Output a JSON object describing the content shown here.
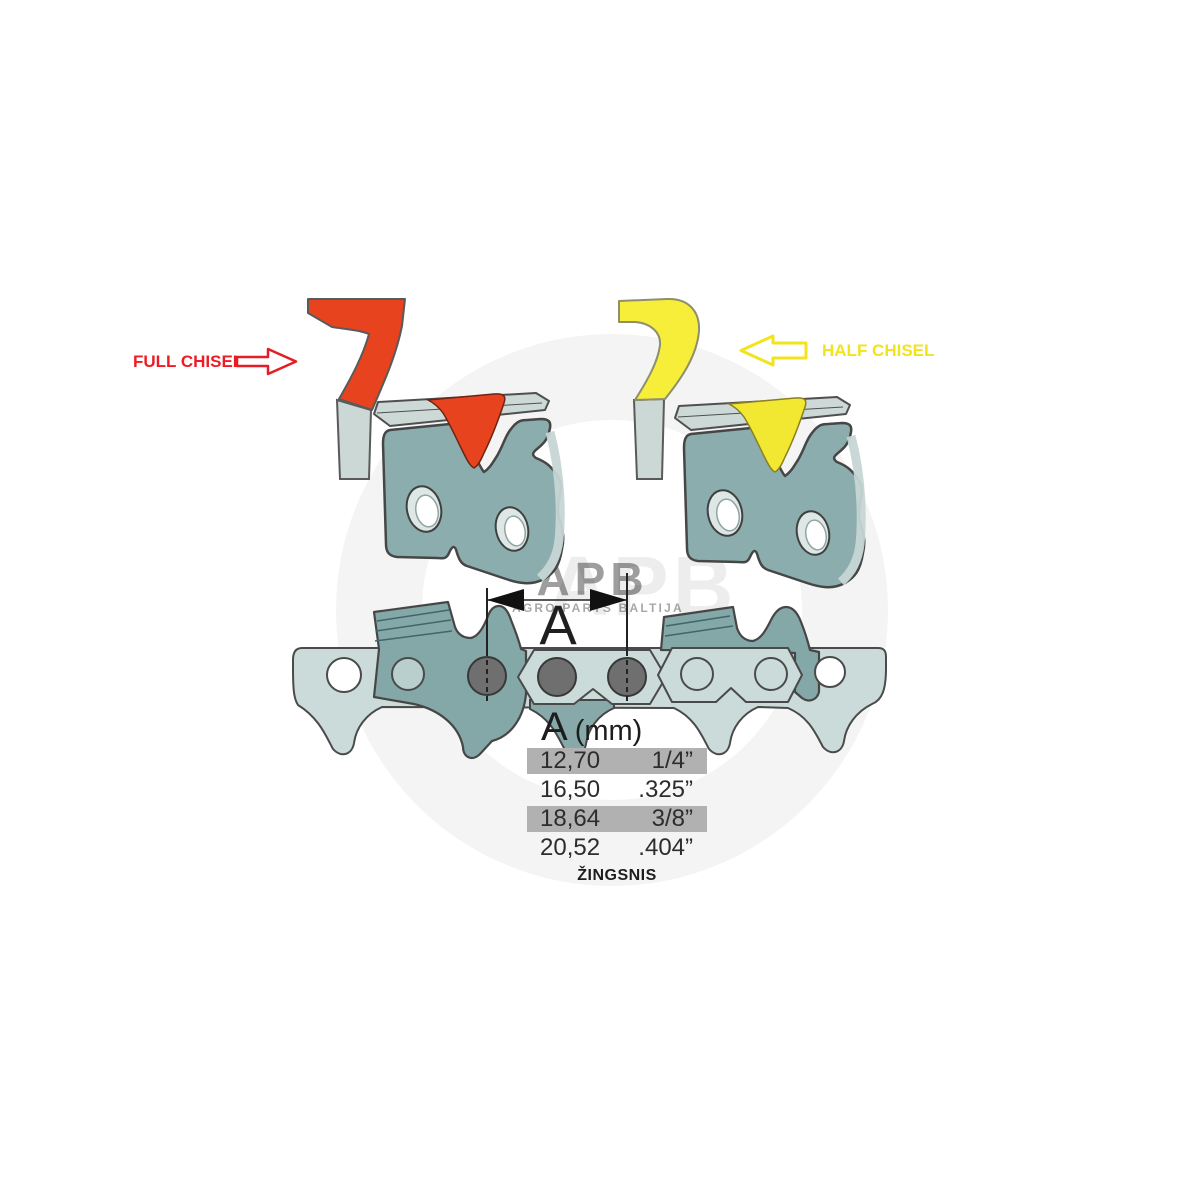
{
  "annotations": {
    "full_chisel": {
      "label": "FULL CHISEL",
      "color": "#ed1c24"
    },
    "half_chisel": {
      "label": "HALF CHISEL",
      "color": "#f2e41c"
    }
  },
  "dimension": {
    "letter": "A"
  },
  "pitch_table": {
    "header": {
      "letter": "A",
      "unit": "(mm)"
    },
    "rows": [
      {
        "mm": "12,70",
        "inches": "1/4”",
        "highlighted": true
      },
      {
        "mm": "16,50",
        "inches": ".325”",
        "highlighted": false
      },
      {
        "mm": "18,64",
        "inches": "3/8”",
        "highlighted": true
      },
      {
        "mm": "20,52",
        "inches": ".404”",
        "highlighted": false
      }
    ],
    "caption": "ŽINGSNIS"
  },
  "watermark": {
    "logo": "APB",
    "tagline": "AGRO PARTS BALTIJA"
  },
  "colors": {
    "full_chisel_red": "#e8431f",
    "half_chisel_yellow": "#f2e832",
    "steel_teal": "#8aacac",
    "steel_light": "#cbdbd9",
    "rivet_gray": "#6f6f6f",
    "table_highlight": "#b1b1b1"
  }
}
